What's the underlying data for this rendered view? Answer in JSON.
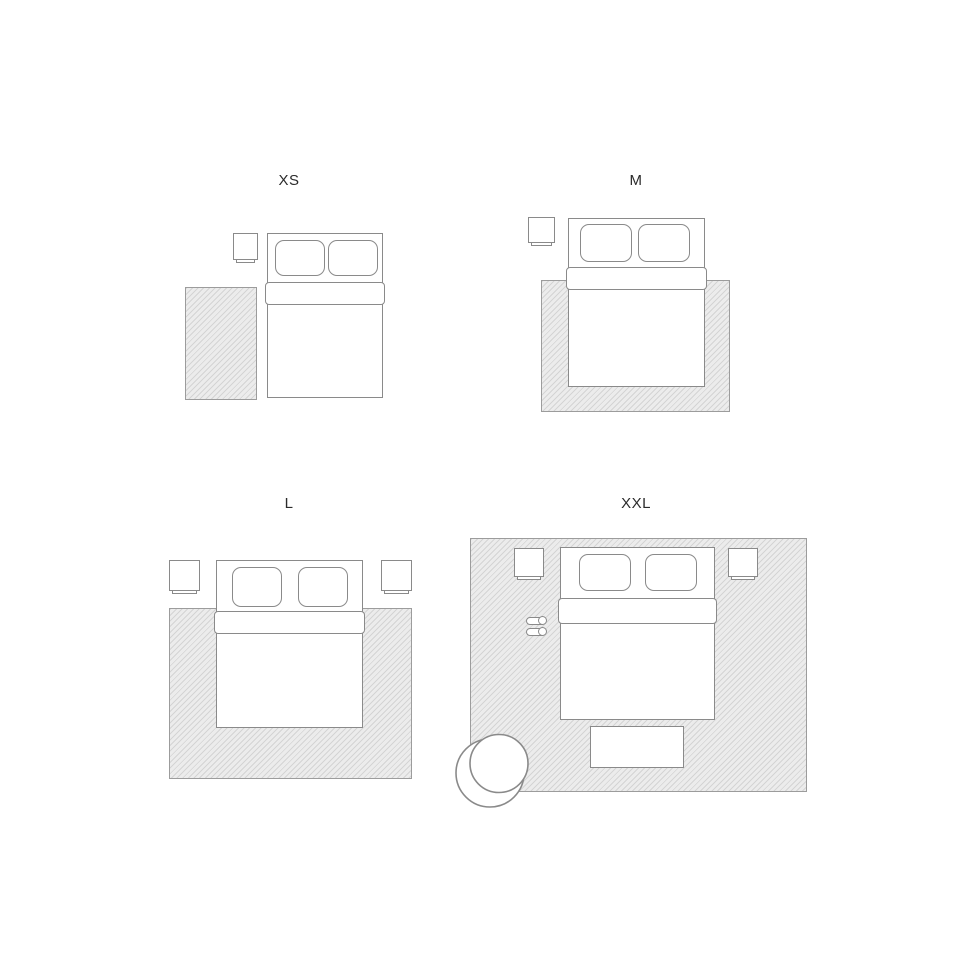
{
  "title": "Rug size guide — bedroom layouts",
  "colors": {
    "outline": "#8a8a8a",
    "rug_fill": "#ececec",
    "rug_border": "#9c9c9c",
    "label": "#2b2b2b",
    "background": "#ffffff"
  },
  "panels": [
    {
      "id": "xs",
      "label": "XS"
    },
    {
      "id": "m",
      "label": "M"
    },
    {
      "id": "l",
      "label": "L"
    },
    {
      "id": "xxl",
      "label": "XXL"
    }
  ]
}
